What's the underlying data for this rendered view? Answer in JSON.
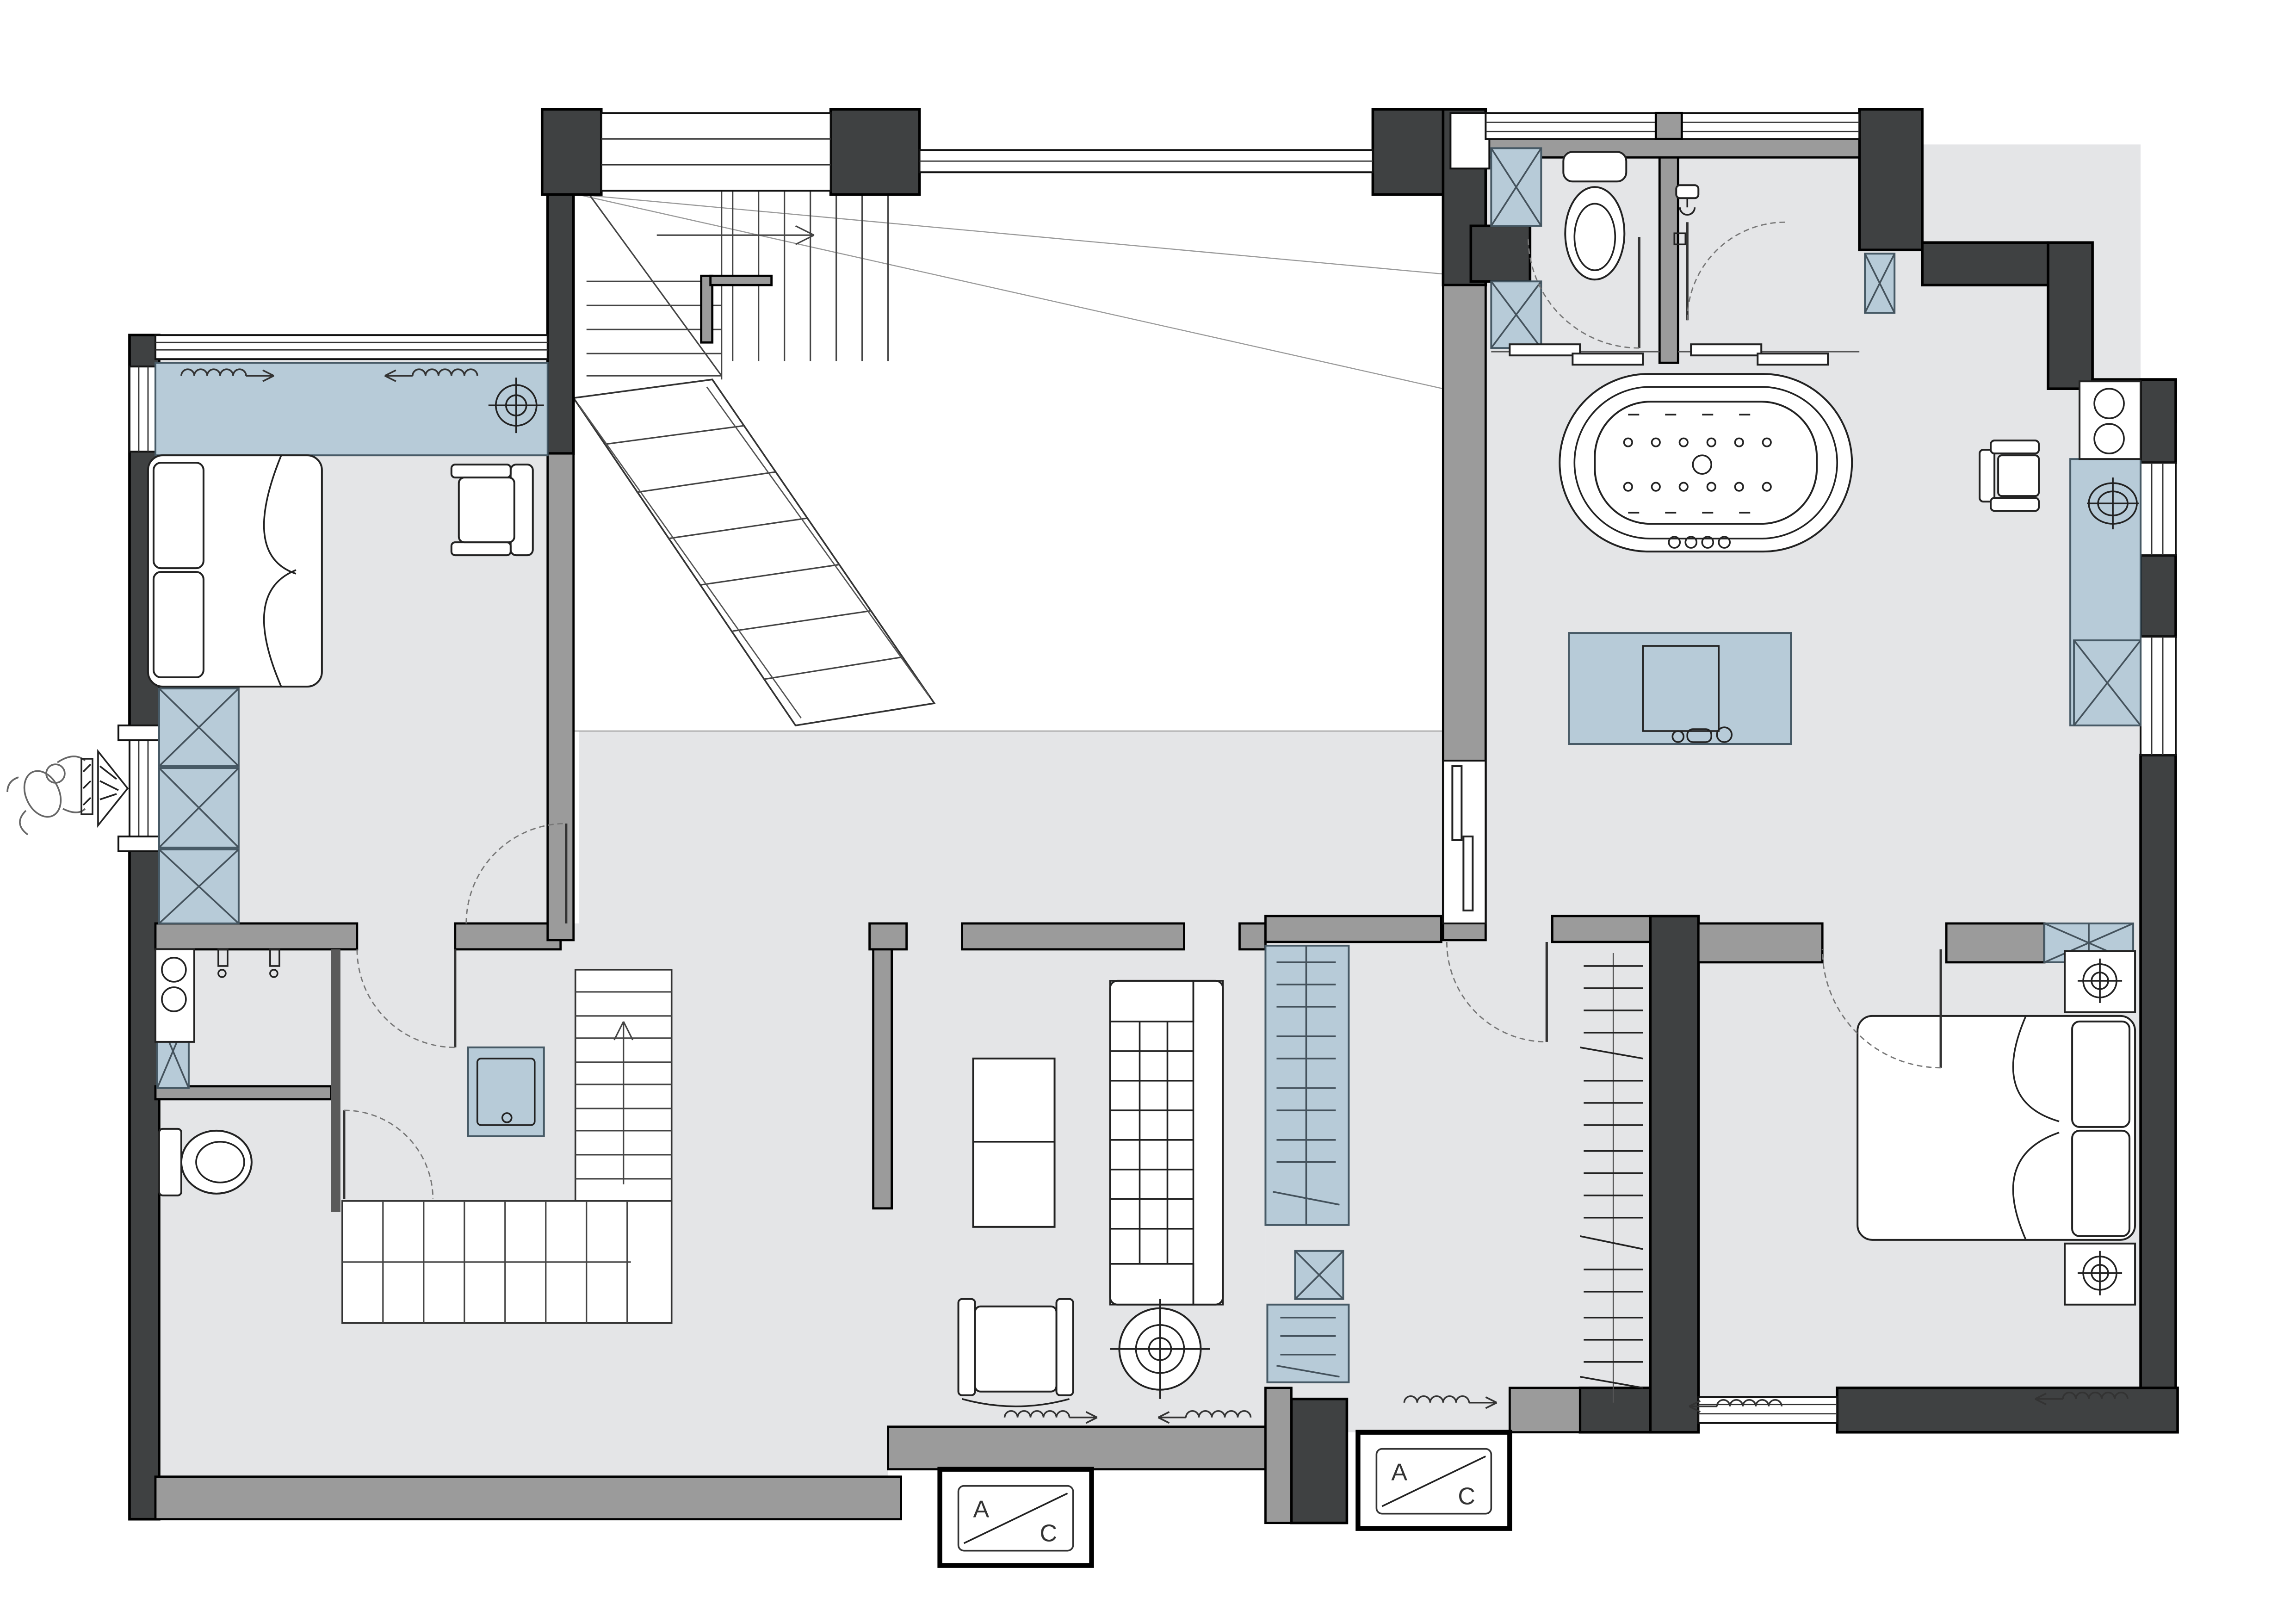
{
  "ac_units": [
    {
      "label_left": "A",
      "label_right": "C"
    },
    {
      "label_left": "A",
      "label_right": "C"
    }
  ],
  "colors": {
    "wall_dark": "#3f4142",
    "wall_gray": "#9b9b9b",
    "floor": "#e4e5e7",
    "casework_blue": "#b7cbd8",
    "casework_border": "#475a66",
    "line": "#1c1c1c",
    "paper": "#ffffff"
  }
}
